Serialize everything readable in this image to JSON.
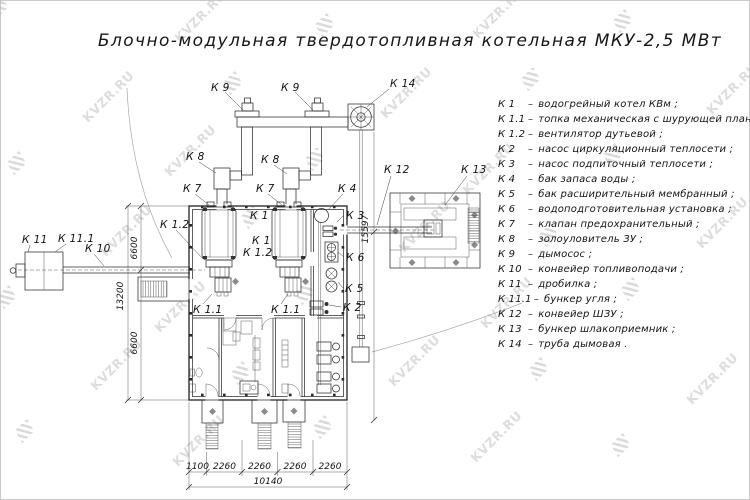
{
  "title": "Блочно-модульная твердотопливная котельная МКУ-2,5 МВт",
  "watermark": {
    "text": "KVZR.RU"
  },
  "colors": {
    "ink": "#2e2e2e",
    "watermark": "#c2c2c2",
    "background": "#ffffff"
  },
  "legend": {
    "dash": "–",
    "items": [
      {
        "key": "К 1",
        "desc": "водогрейный котел КВм ;"
      },
      {
        "key": "К 1.1",
        "desc": "топка механическая с шурующей планкой ;"
      },
      {
        "key": "К 1.2",
        "desc": "вентилятор дутьевой ;"
      },
      {
        "key": "К 2",
        "desc": "насос циркуляционный теплосети ;"
      },
      {
        "key": "К 3",
        "desc": "насос подпиточный теплосети ;"
      },
      {
        "key": "К 4",
        "desc": "бак запаса воды ;"
      },
      {
        "key": "К 5",
        "desc": "бак расширительный мембранный ;"
      },
      {
        "key": "К 6",
        "desc": "водоподготовительная установка ;"
      },
      {
        "key": "К 7",
        "desc": "клапан предохранительный ;"
      },
      {
        "key": "К 8",
        "desc": "золоуловитель ЗУ ;"
      },
      {
        "key": "К 9",
        "desc": "дымосос ;"
      },
      {
        "key": "К 10",
        "desc": "конвейер топливоподачи ;"
      },
      {
        "key": "К 11",
        "desc": "дробилка ;"
      },
      {
        "key": "К 11.1",
        "desc": "бункер угля ;"
      },
      {
        "key": "К 12",
        "desc": "конвейер ШЗУ ;"
      },
      {
        "key": "К 13",
        "desc": "бункер шлакоприемник ;"
      },
      {
        "key": "К 14",
        "desc": "труба дымовая ."
      }
    ]
  },
  "plan": {
    "labels": {
      "k9_left": "К 9",
      "k9_right": "К 9",
      "k14": "К 14",
      "k8_left": "К 8",
      "k8_right": "К 8",
      "k7_left": "К 7",
      "k7_right": "К 7",
      "k4": "К 4",
      "k3": "К 3",
      "k6": "К 6",
      "k5": "К 5",
      "k2": "К 2",
      "k1_a": "К 1",
      "k1_b": "К 1",
      "k1_2_a": "К 1.2",
      "k1_2_b": "К 1.2",
      "k1_1_left": "К 1.1",
      "k1_1_right": "К 1.1",
      "k10": "К 10",
      "k11": "К 11",
      "k11_1": "К 11.1",
      "k12": "К 12",
      "k13": "К 13"
    },
    "dimensions": {
      "left_seg_top": "6600",
      "left_total": "13200",
      "left_seg_bottom": "6600",
      "height_right": "15597",
      "bottom_1": "1100",
      "bottom_2": "2260",
      "bottom_3": "2260",
      "bottom_4": "2260",
      "bottom_5": "2260",
      "bottom_total": "10140"
    }
  }
}
